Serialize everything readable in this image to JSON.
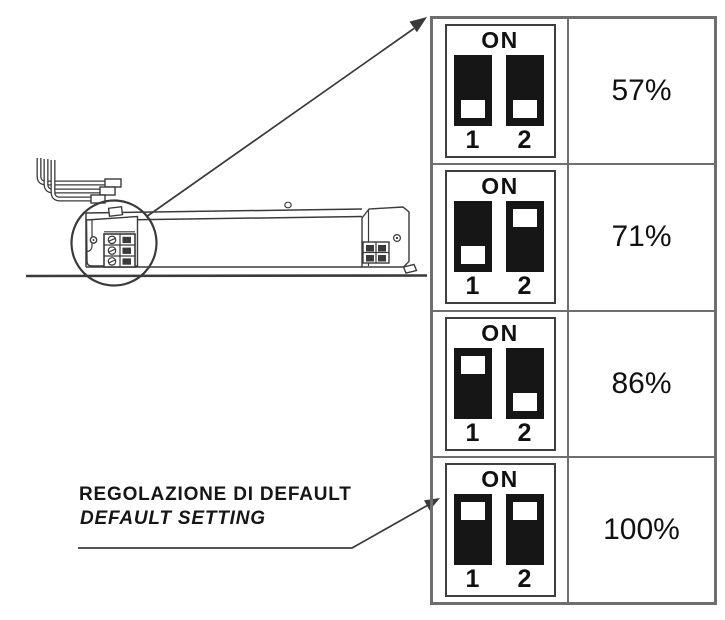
{
  "figure": {
    "table": {
      "on_label": "ON",
      "switch_labels": [
        "1",
        "2"
      ],
      "rows": [
        {
          "percent": "57%",
          "switch1": "off",
          "switch2": "off"
        },
        {
          "percent": "71%",
          "switch1": "off",
          "switch2": "on"
        },
        {
          "percent": "86%",
          "switch1": "on",
          "switch2": "off"
        },
        {
          "percent": "100%",
          "switch1": "on",
          "switch2": "on"
        }
      ]
    },
    "default_label": {
      "line1": "REGOLAZIONE DI DEFAULT",
      "line2": "DEFAULT SETTING"
    },
    "illustration_parts": [
      "driver-unit",
      "input-wires",
      "terminal-block",
      "end-cap-terminal",
      "magnifier-circle",
      "callout-arrow",
      "default-setting-arrow"
    ],
    "colors": {
      "ink": "#3a3a3a",
      "table_border": "#6e6e6e",
      "dip_box_border": "#3f3f3f",
      "switch_fill": "#161616",
      "text": "#111111"
    }
  }
}
